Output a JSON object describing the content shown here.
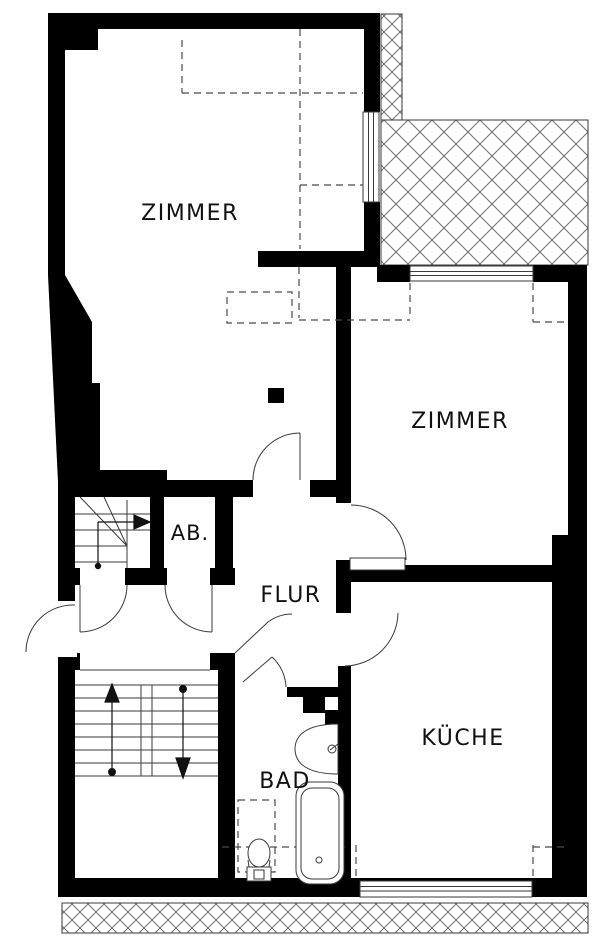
{
  "plan": {
    "rooms": [
      {
        "id": "zimmer-top-left",
        "label": "ZIMMER"
      },
      {
        "id": "zimmer-right",
        "label": "ZIMMER"
      },
      {
        "id": "abstellraum",
        "label": "AB."
      },
      {
        "id": "flur",
        "label": "FLUR"
      },
      {
        "id": "kueche",
        "label": "KÜCHE"
      },
      {
        "id": "bad",
        "label": "BAD"
      }
    ],
    "colors": {
      "wall": "#000000",
      "background": "#ffffff",
      "line": "#3a3a3a",
      "dash": "#4a4a4a",
      "hatch": "#6f6f6f",
      "text": "#111111"
    },
    "fixtures": [
      {
        "name": "bathtub"
      },
      {
        "name": "washbasin"
      },
      {
        "name": "toilet"
      }
    ],
    "stairs": [
      {
        "name": "main-staircase",
        "arrows": [
          "up",
          "down"
        ]
      },
      {
        "name": "winder-stair",
        "arrows": [
          "right"
        ]
      }
    ],
    "areas": [
      {
        "name": "balcony-hatched"
      },
      {
        "name": "ground-hatched-strip"
      }
    ]
  }
}
